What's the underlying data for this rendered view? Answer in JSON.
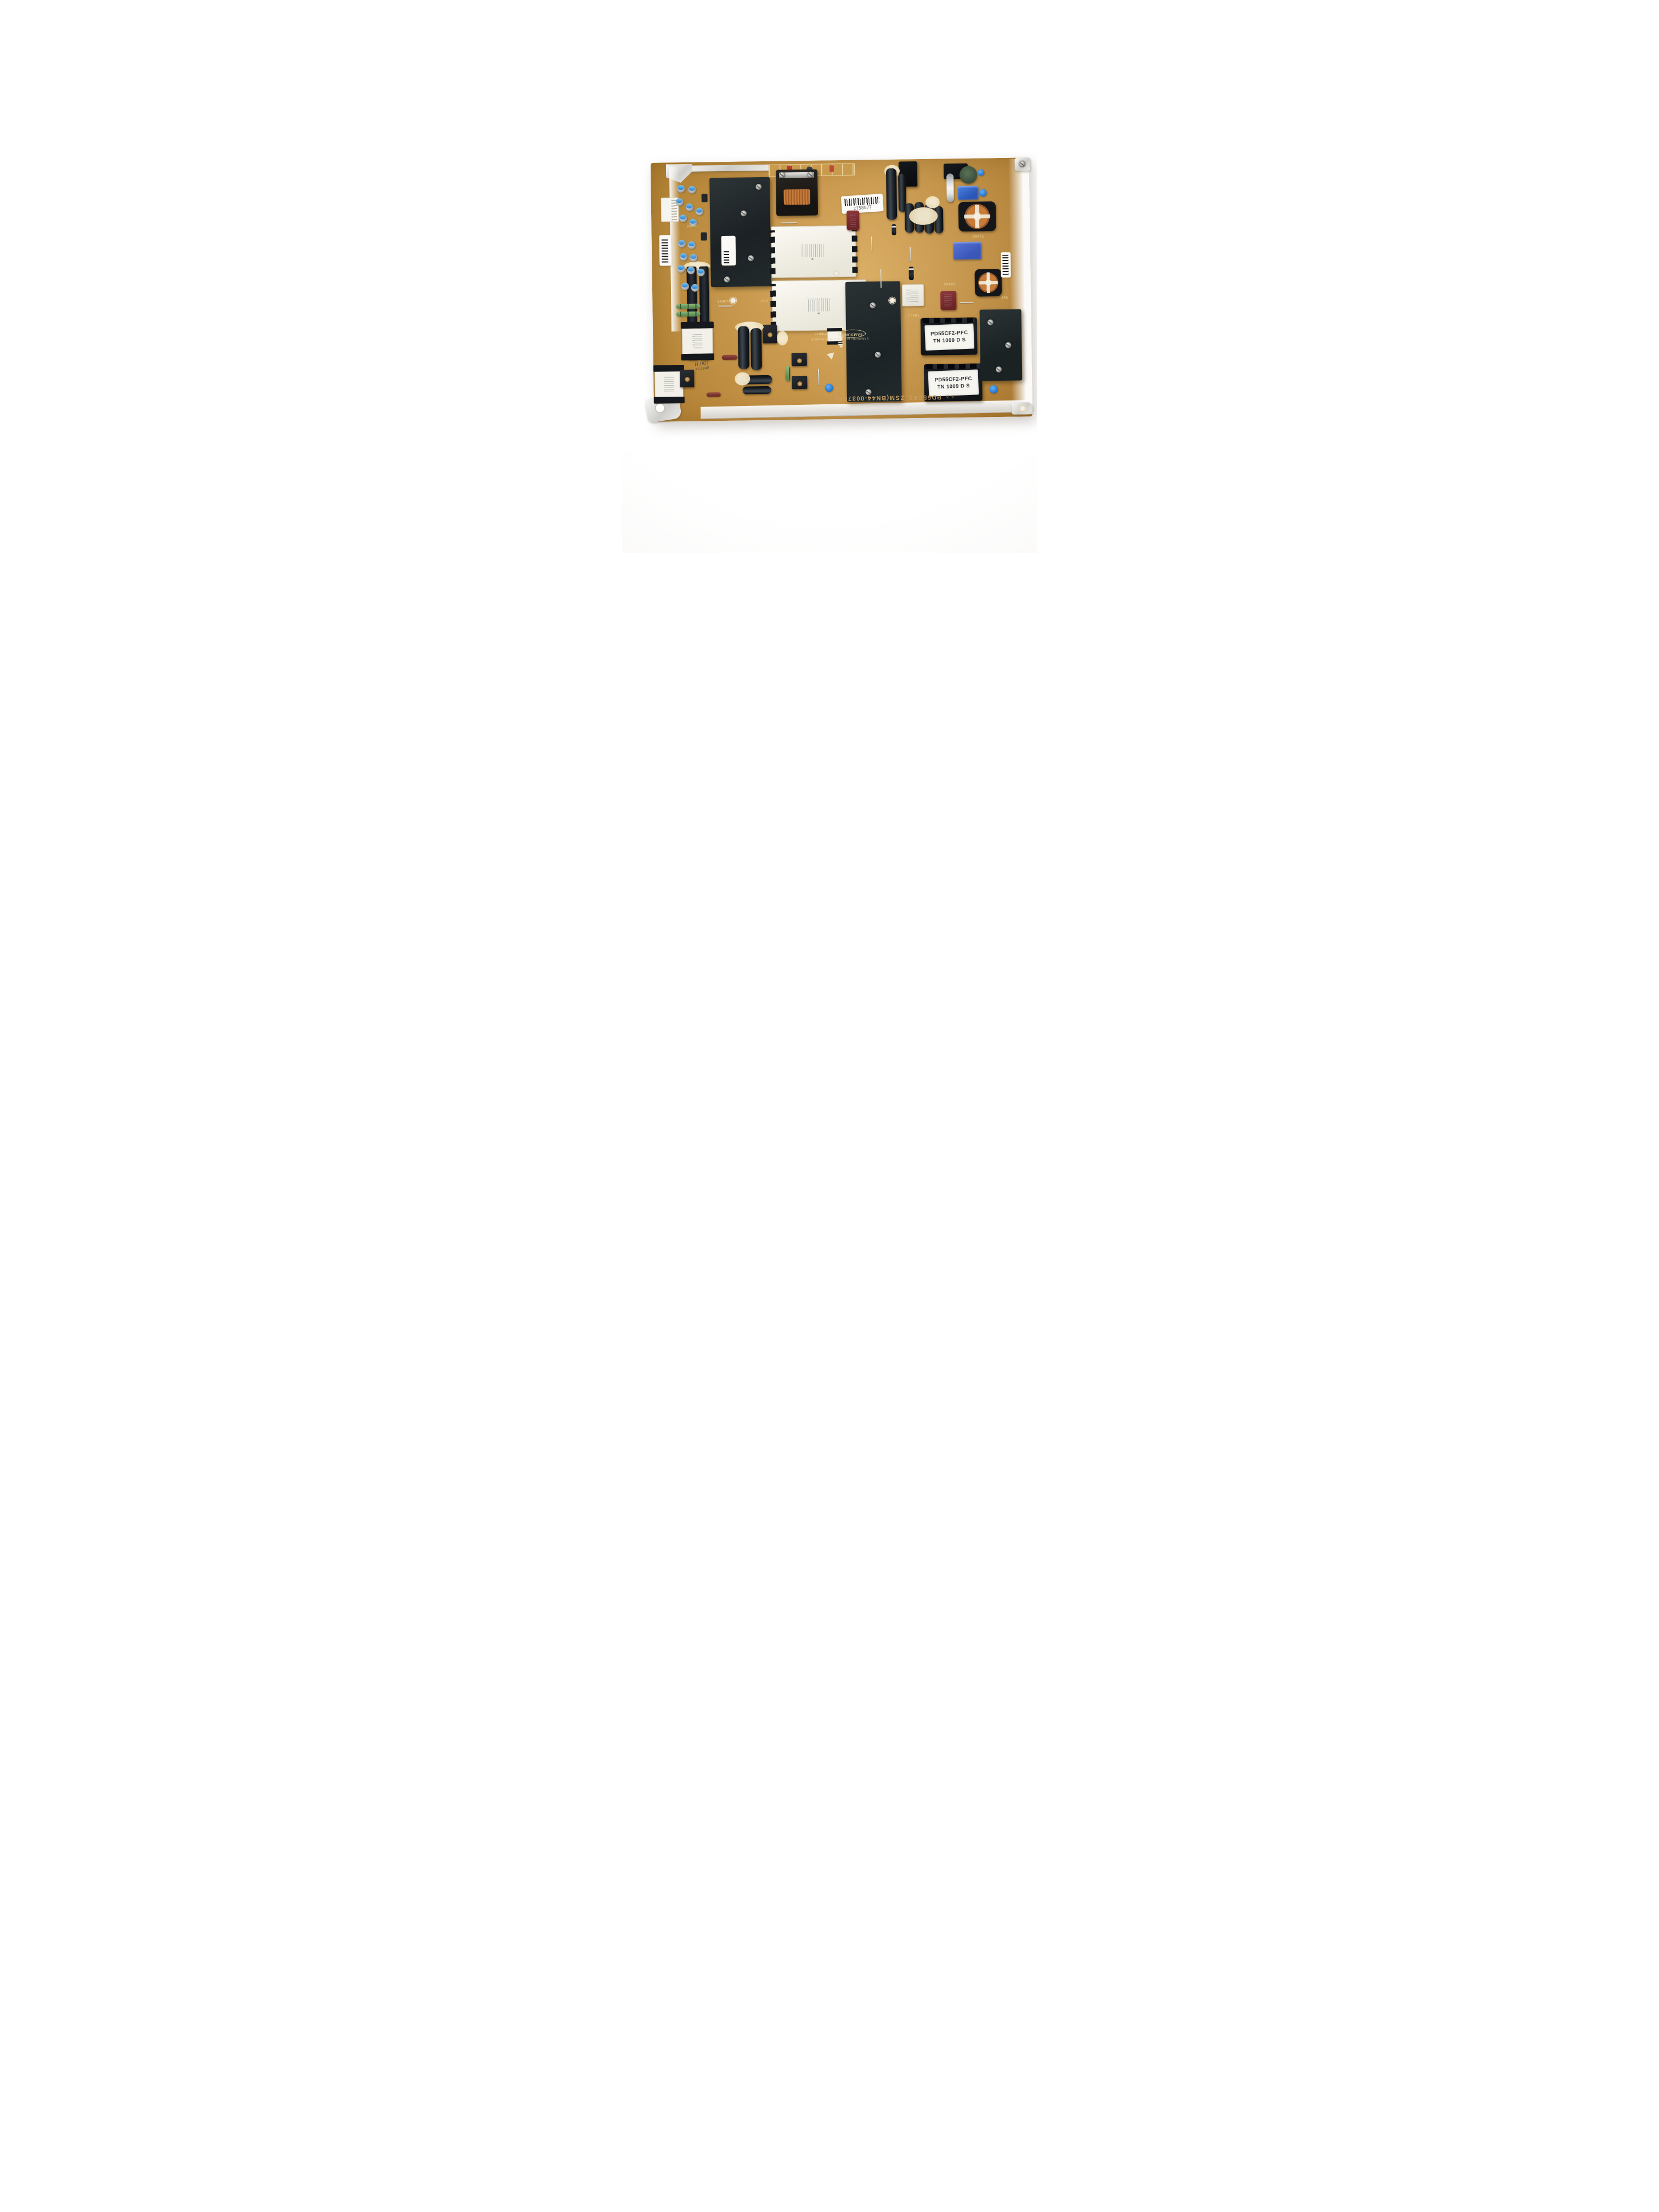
{
  "photo": {
    "subject": "Samsung TV power supply board (PCB) photographed on a white background"
  },
  "board": {
    "bottom_silkscreen": "PD55CF2_ZSM(BN44-00376A)",
    "brand_logo": "SAMSUNG",
    "brand_line": "SAMSUNG ELECTRO-MECHANICS",
    "orientation_mark": "DIP",
    "handwritten_mark": "H.001",
    "handwritten_sub": "48-1940",
    "sticker_number": "2758877",
    "warning_symbols": "⚠ ⚠"
  },
  "pfc_transformer_label": {
    "line1": "PD55CF2-PFC",
    "line2": "TN 1009 D S"
  },
  "silkscreen_refs": {
    "r1": "CM856",
    "r2": "J891",
    "r3": "LP801",
    "r4": "CP801",
    "r5": "TM8015",
    "r6": "CM811",
    "r7": "GM855",
    "r8": "SP5"
  },
  "colors": {
    "pcb": "#c8913f",
    "heatsink": "#20262a",
    "copper": "#c67b39",
    "cap_top_blue": "#3f8fd8",
    "film_cap_blue": "#2e62c8",
    "varistor_green": "#44543f",
    "film_cap_maroon": "#7c2d30",
    "label_white": "#f6f5f0"
  }
}
